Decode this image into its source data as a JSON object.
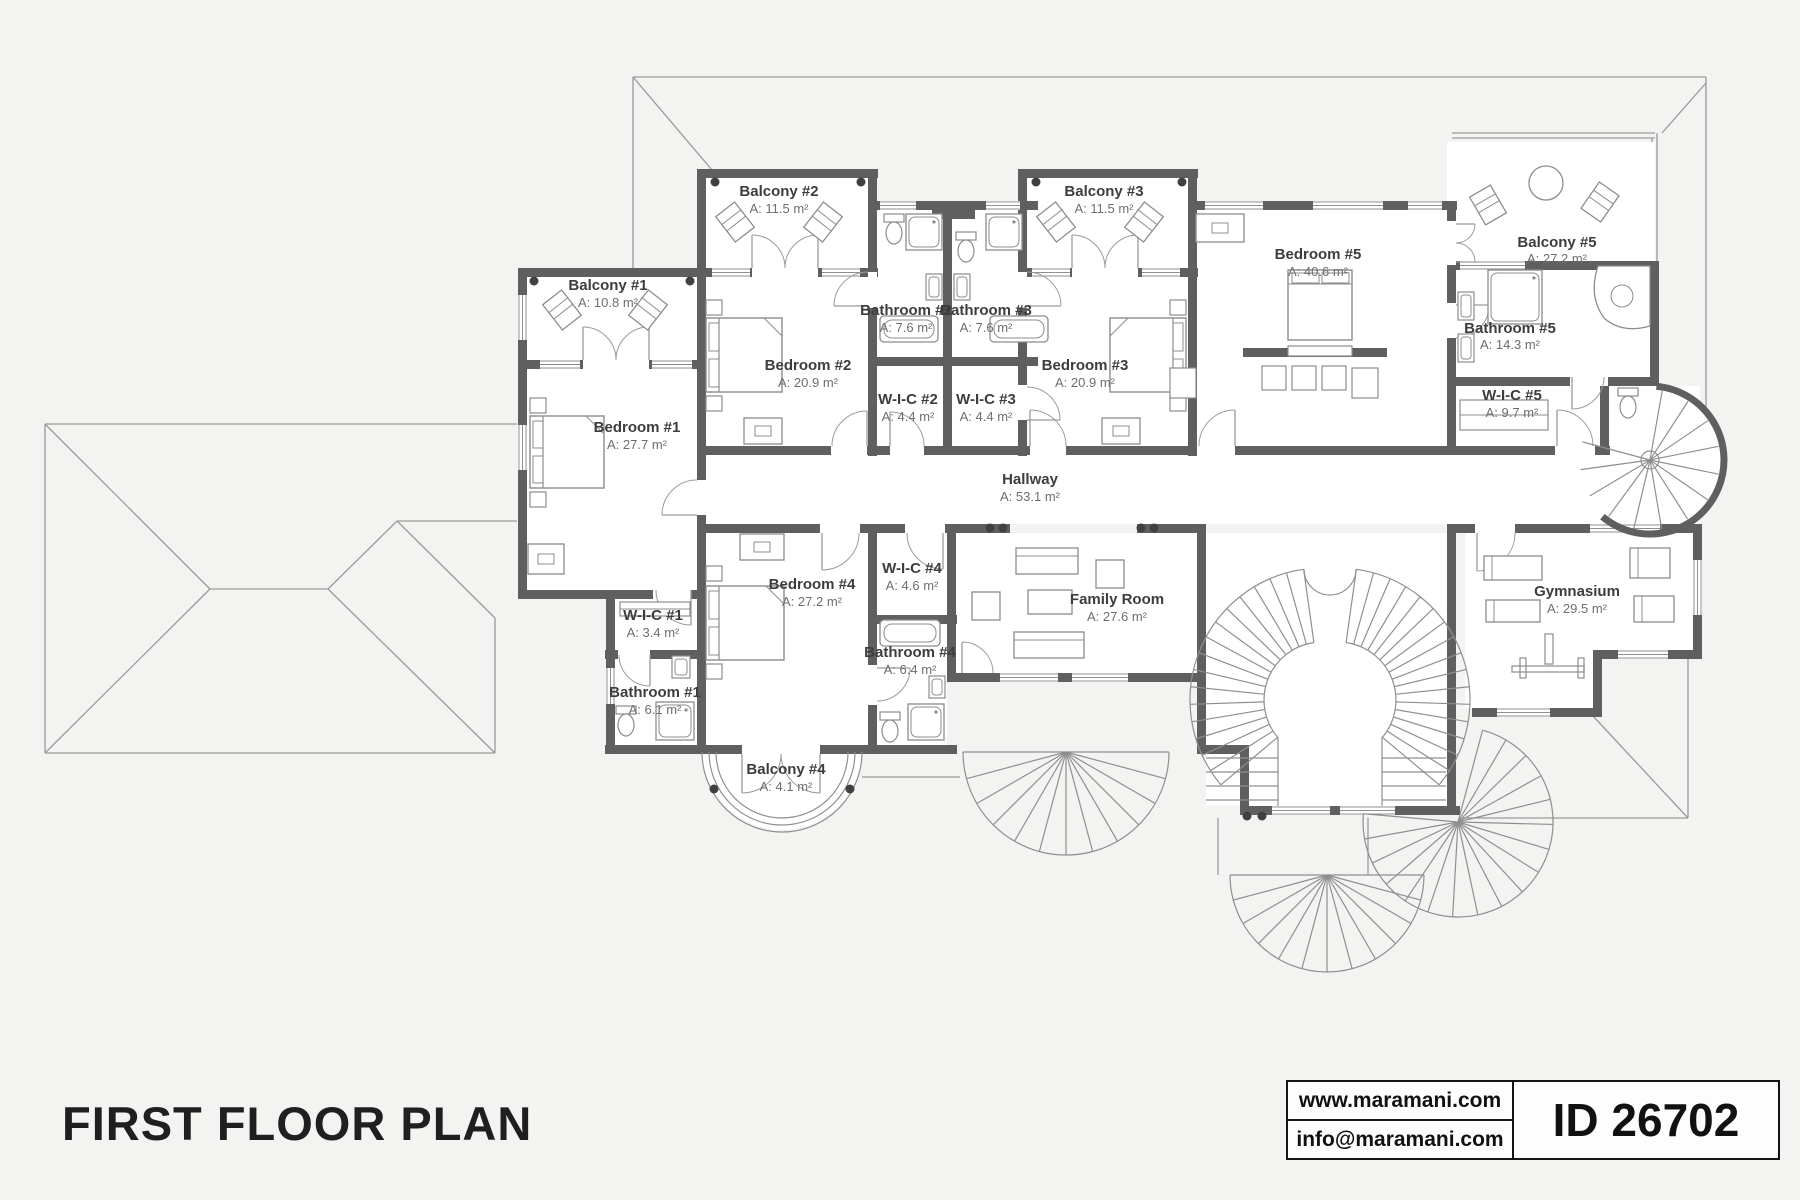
{
  "title": "FIRST FLOOR PLAN",
  "footer": {
    "website": "www.maramani.com",
    "email": "info@maramani.com",
    "plan_id": "ID 26702"
  },
  "stairs": {
    "grand_staircase_steps": "19"
  },
  "colors": {
    "wall": "#5f5f5f",
    "cap": "#404040",
    "thin": "#8f8f8f",
    "furn": "#8c8c8c",
    "floor": "#ffffff",
    "bg": "#f3f3f2",
    "name_text": "#3d3d3d",
    "area_text": "#6e6e6e"
  },
  "rooms": {
    "balcony1": {
      "name": "Balcony #1",
      "area": "A: 10.8 m²"
    },
    "balcony2": {
      "name": "Balcony #2",
      "area": "A: 11.5 m²"
    },
    "balcony3": {
      "name": "Balcony #3",
      "area": "A: 11.5 m²"
    },
    "balcony4": {
      "name": "Balcony #4",
      "area": "A: 4.1 m²"
    },
    "balcony5": {
      "name": "Balcony #5",
      "area": "A: 27.2 m²"
    },
    "bedroom1": {
      "name": "Bedroom #1",
      "area": "A: 27.7 m²"
    },
    "bedroom2": {
      "name": "Bedroom #2",
      "area": "A: 20.9 m²"
    },
    "bedroom3": {
      "name": "Bedroom #3",
      "area": "A: 20.9 m²"
    },
    "bedroom4": {
      "name": "Bedroom #4",
      "area": "A: 27.2 m²"
    },
    "bedroom5": {
      "name": "Bedroom #5",
      "area": "A: 40.6 m²"
    },
    "bathroom1": {
      "name": "Bathroom #1",
      "area": "A: 6.1 m²"
    },
    "bathroom2": {
      "name": "Bathroom #2",
      "area": "A: 7.6 m²"
    },
    "bathroom3": {
      "name": "Bathroom #3",
      "area": "A: 7.6 m²"
    },
    "bathroom4": {
      "name": "Bathroom #4",
      "area": "A: 6.4 m²"
    },
    "bathroom5": {
      "name": "Bathroom #5",
      "area": "A: 14.3 m²"
    },
    "wic1": {
      "name": "W-I-C #1",
      "area": "A: 3.4 m²"
    },
    "wic2": {
      "name": "W-I-C #2",
      "area": "A: 4.4 m²"
    },
    "wic3": {
      "name": "W-I-C #3",
      "area": "A: 4.4 m²"
    },
    "wic4": {
      "name": "W-I-C #4",
      "area": "A: 4.6 m²"
    },
    "wic5": {
      "name": "W-I-C #5",
      "area": "A: 9.7 m²"
    },
    "hallway": {
      "name": "Hallway",
      "area": "A: 53.1 m²"
    },
    "family": {
      "name": "Family Room",
      "area": "A: 27.6 m²"
    },
    "gym": {
      "name": "Gymnasium",
      "area": "A: 29.5 m²"
    }
  }
}
